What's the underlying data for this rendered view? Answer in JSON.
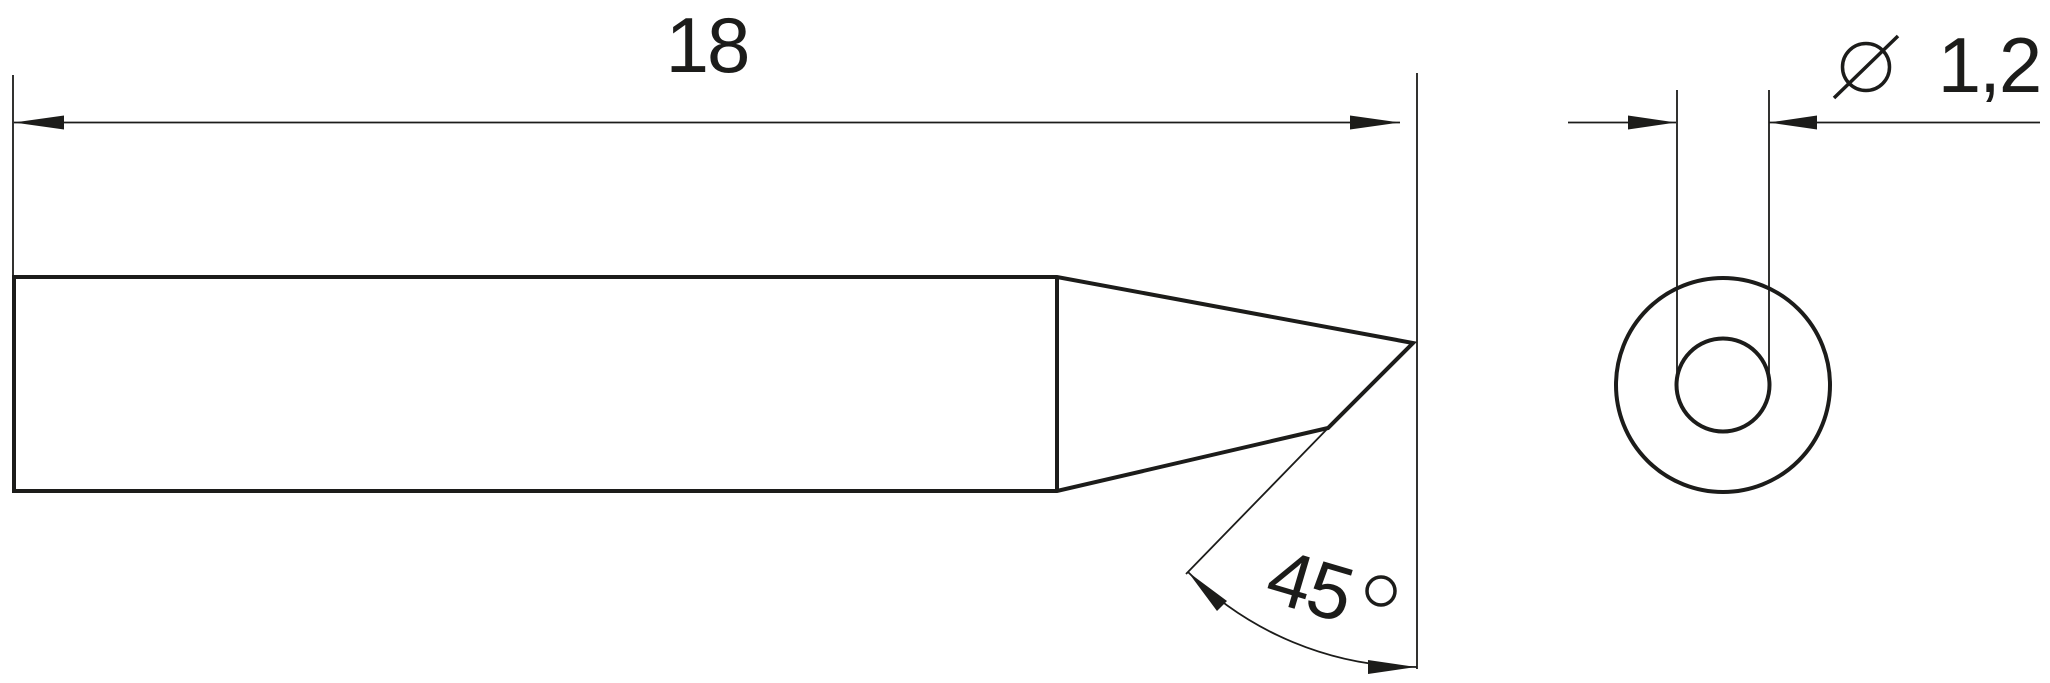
{
  "page": {
    "background_color": "#ffffff",
    "line_color": "#1c1c1a"
  },
  "drawing": {
    "side_view": {
      "length_dim": {
        "value": "18"
      },
      "angle_dim": {
        "value": "45",
        "unit_symbol": "°",
        "full_label": "45 °"
      }
    },
    "front_view": {
      "diameter_dim": {
        "symbol": "⌀",
        "value": "1,2",
        "full_label": "⌀ 1,2"
      }
    }
  }
}
